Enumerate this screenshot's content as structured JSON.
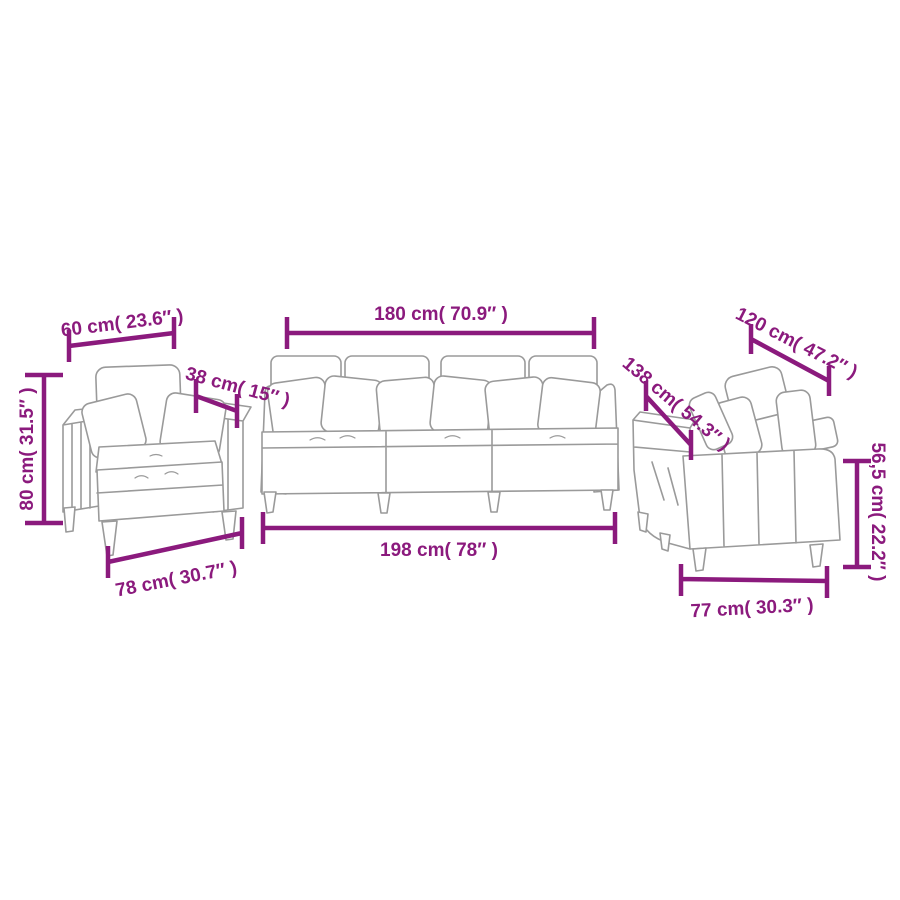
{
  "colors": {
    "dimension": "#8b1a7d",
    "line_art": "#9a9a9a",
    "background": "#ffffff"
  },
  "armchair": {
    "width_top": "60 cm( 23.6″ )",
    "depth": "38 cm( 15″ )",
    "height": "80 cm( 31.5″ )",
    "width_bottom": "78 cm( 30.7″ )"
  },
  "sofa_three_seater": {
    "width_top": "180 cm( 70.9″ )",
    "width_bottom": "198 cm( 78″ )"
  },
  "sofa_two_seater": {
    "width_top": "120 cm( 47.2″ )",
    "depth": "138 cm( 54.3″ )",
    "height": "56,5 cm( 22.2″ )",
    "width_bottom": "77 cm( 30.3″ )"
  }
}
